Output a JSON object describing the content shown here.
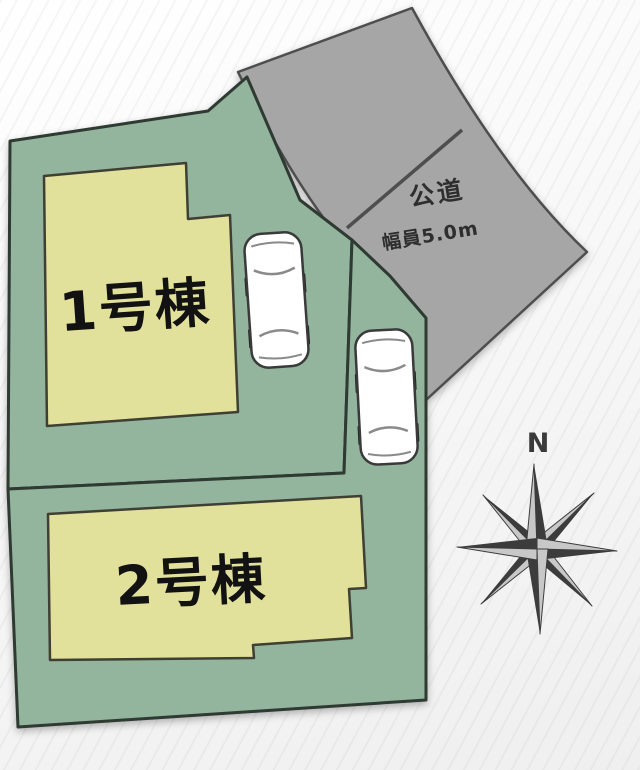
{
  "plan": {
    "lot1": {
      "building_label": "1号棟"
    },
    "lot2": {
      "building_label": "2号棟"
    },
    "road": {
      "label_line1": "公道",
      "label_line2": "幅員5.0m"
    },
    "compass": {
      "north_label": "N"
    }
  },
  "icons": {
    "compass": "compass-rose-icon",
    "car": "car-top-view-icon"
  },
  "colors": {
    "lot_fill": "#93b49d",
    "lot_border": "#2e3a32",
    "building_fill": "#e2e19b",
    "building_border": "#3f3f33",
    "road_fill": "#a6a6a6",
    "road_border": "#4e4e4e",
    "road_divider": "#4e4e4e",
    "car_fill": "#ffffff",
    "car_border": "#3a3a3a",
    "wheel_color": "#222222",
    "glass_line": "#8a8a8a",
    "compass_dark": "#3c3c3c",
    "compass_light": "#c8c8c8",
    "building_label_color": "#121212",
    "road_label_color": "#2e2e2e",
    "north_label_color": "#3a3a3a"
  }
}
